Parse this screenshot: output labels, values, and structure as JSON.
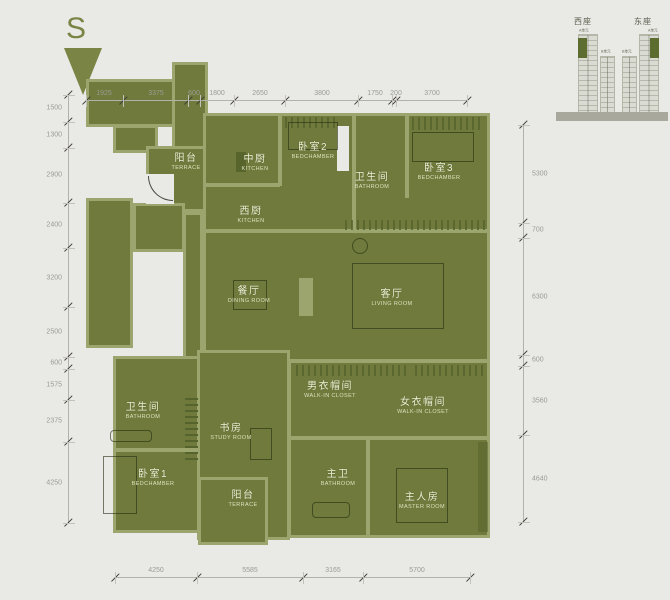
{
  "compass": {
    "label": "S"
  },
  "colors": {
    "background": "#e9e9e6",
    "plan_fill": "#6f7a3c",
    "wall": "#9da56f",
    "accent_dark": "#55632c",
    "dim_text": "#9c9c94",
    "room_text": "#eef0d6"
  },
  "dims": {
    "top": [
      "1925",
      "3375",
      "600",
      "1800",
      "2650",
      "3800",
      "1750",
      "200",
      "3700"
    ],
    "left": [
      "1500",
      "1300",
      "2900",
      "2400",
      "3200",
      "2500",
      "600",
      "1575",
      "2375",
      "4250"
    ],
    "right": [
      "5300",
      "700",
      "6300",
      "600",
      "3560",
      "4640"
    ],
    "bottom": [
      "4250",
      "5585",
      "3165",
      "5700"
    ]
  },
  "rooms": [
    {
      "id": "terrace-upper",
      "zh": "阳台",
      "en": "TERRACE"
    },
    {
      "id": "kitchen-chinese",
      "zh": "中厨",
      "en": "KITCHEN"
    },
    {
      "id": "bedroom-2",
      "zh": "卧室2",
      "en": "BEDCHAMBER"
    },
    {
      "id": "bathroom-upper",
      "zh": "卫生间",
      "en": "BATHROOM"
    },
    {
      "id": "bedroom-3",
      "zh": "卧室3",
      "en": "BEDCHAMBER"
    },
    {
      "id": "kitchen-west",
      "zh": "西厨",
      "en": "KITCHEN"
    },
    {
      "id": "dining-room",
      "zh": "餐厅",
      "en": "DINING ROOM"
    },
    {
      "id": "living-room",
      "zh": "客厅",
      "en": "LIVING ROOM"
    },
    {
      "id": "walkin-closet-male",
      "zh": "男衣帽间",
      "en": "WALK-IN CLOSET"
    },
    {
      "id": "walkin-closet-female",
      "zh": "女衣帽间",
      "en": "WALK-IN CLOSET"
    },
    {
      "id": "bathroom-lower",
      "zh": "卫生间",
      "en": "BATHROOM"
    },
    {
      "id": "study-room",
      "zh": "书房",
      "en": "STUDY ROOM"
    },
    {
      "id": "bedroom-1",
      "zh": "卧室1",
      "en": "BEDCHAMBER"
    },
    {
      "id": "terrace-lower",
      "zh": "阳台",
      "en": "TERRACE"
    },
    {
      "id": "bathroom-master",
      "zh": "主卫",
      "en": "BATHROOM"
    },
    {
      "id": "master-room",
      "zh": "主人房",
      "en": "MASTER ROOM"
    }
  ],
  "keyplan": {
    "west_block": "西座",
    "east_block": "东座",
    "unit_a": "A单元",
    "unit_b": "B单元"
  }
}
